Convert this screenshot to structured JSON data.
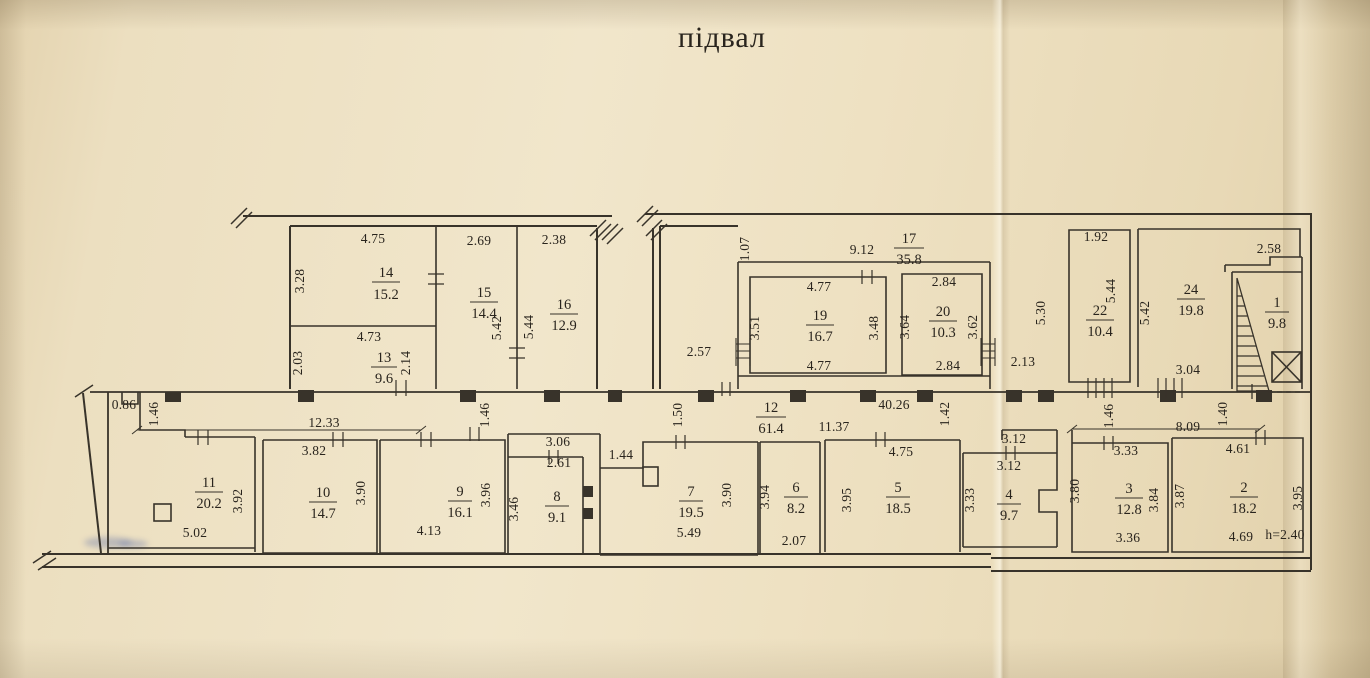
{
  "title": "підвал",
  "rooms": {
    "1": {
      "n": "1",
      "a": "9.8",
      "w": "2.58"
    },
    "2": {
      "n": "2",
      "a": "18.2",
      "t": "4.61",
      "l": "3.87",
      "r": "3.95",
      "b": "4.69",
      "h": "h=2.40"
    },
    "3": {
      "n": "3",
      "a": "12.8",
      "t": "3.33",
      "l": "3.80",
      "r": "3.84",
      "b": "3.36"
    },
    "4": {
      "n": "4",
      "a": "9.7",
      "t": "3.12",
      "t2": "3.12",
      "l": "3.33"
    },
    "5": {
      "n": "5",
      "a": "18.5",
      "t": "4.75",
      "l": "3.95"
    },
    "6": {
      "n": "6",
      "a": "8.2",
      "l": "3.94",
      "b": "2.07"
    },
    "7": {
      "n": "7",
      "a": "19.5",
      "t": "1.44",
      "r": "3.90",
      "b": "5.49"
    },
    "8": {
      "n": "8",
      "a": "9.1",
      "t": "3.06",
      "t2": "2.61",
      "l": "3.46"
    },
    "9": {
      "n": "9",
      "a": "16.1",
      "r": "3.96",
      "b": "4.13"
    },
    "10": {
      "n": "10",
      "a": "14.7",
      "t": "3.82",
      "r": "3.90"
    },
    "11": {
      "n": "11",
      "a": "20.2",
      "r": "3.92",
      "b": "5.02"
    },
    "13": {
      "n": "13",
      "a": "9.6",
      "t": "4.73",
      "l": "2.03",
      "r": "2.14"
    },
    "14": {
      "n": "14",
      "a": "15.2",
      "t": "4.75",
      "l": "3.28"
    },
    "15": {
      "n": "15",
      "a": "14.4",
      "t": "2.69",
      "r": "5.42"
    },
    "16": {
      "n": "16",
      "a": "12.9",
      "t": "2.38",
      "l": "5.44"
    },
    "17": {
      "n": "17",
      "a": "35.8",
      "t": "9.12",
      "l": "1.07"
    },
    "19": {
      "n": "19",
      "a": "16.7",
      "t": "4.77",
      "l": "3.51",
      "r": "3.48",
      "b": "4.77"
    },
    "20": {
      "n": "20",
      "a": "10.3",
      "t": "2.84",
      "l": "3.64",
      "r": "3.62",
      "b": "2.84"
    },
    "22": {
      "n": "22",
      "a": "10.4",
      "t": "1.92",
      "r": "5.44"
    },
    "24": {
      "n": "24",
      "a": "19.8",
      "l": "5.42",
      "b": "3.04"
    }
  },
  "corridor": {
    "n": "12",
    "a": "61.4",
    "d_4026": "40.26",
    "d_1137": "11.37",
    "d_1233": "12.33",
    "d_809": "8.09",
    "d_142": "1.42",
    "d_150": "1.50",
    "d_146_1": "1.46",
    "d_146_2": "1.46",
    "d_146_3": "1.46",
    "d_140": "1.40",
    "d_086": "0.86",
    "d_257": "2.57",
    "d_213": "2.13",
    "d_530": "5.30"
  },
  "symbols": {
    "stairs": "hatched-stairs-triangle",
    "shaft": "crossed-square-shaft"
  },
  "colors": {
    "paper": "#eee0c1",
    "line": "#38332a",
    "ink": "#29241d",
    "smudge": "#5468a4"
  }
}
